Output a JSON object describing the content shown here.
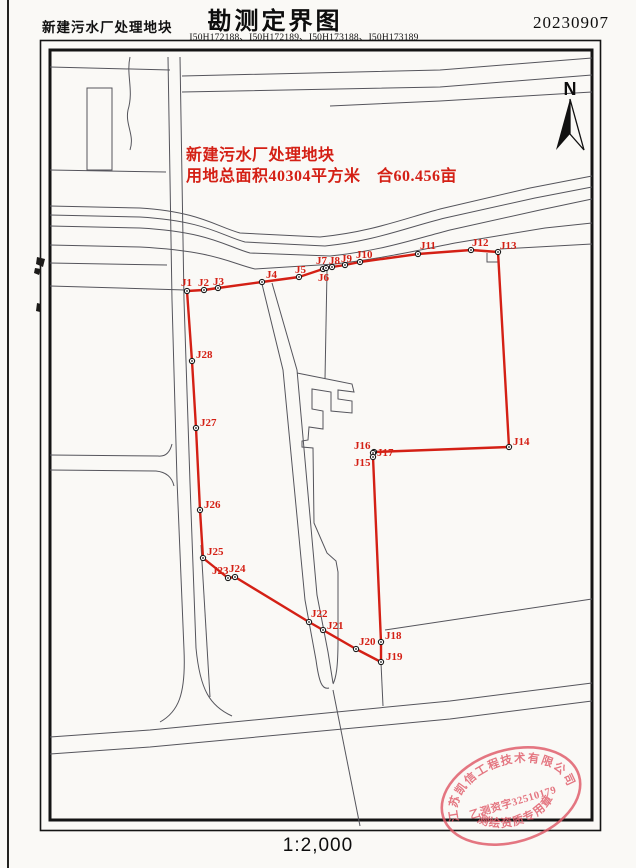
{
  "header": {
    "project_label": "新建污水厂处理地块",
    "title": "勘测定界图",
    "sheet_numbers": "I50H172188、I50H172189、I50H173188、I50H173189",
    "date": "20230907"
  },
  "map_annotation": {
    "line1": "新建污水厂处理地块",
    "line2": "用地总面积40304平方米　合60.456亩"
  },
  "land_area": {
    "sqm": 40304,
    "mu": 60.456
  },
  "north_arrow": {
    "label": "N"
  },
  "scale_bar": {
    "label": "1:2,000"
  },
  "seal": {
    "company": "江苏凯信工程技术有限公司",
    "license_no": "乙测资字32510179",
    "seal_type": "测绘资质专用章"
  },
  "colors": {
    "boundary_red": "#d42015",
    "seal_pink": "#e05a68",
    "map_line_gray": "#55555c"
  },
  "boundary_points": [
    {
      "name": "J1",
      "x": 187,
      "y": 291,
      "lx": 181,
      "ly": 286
    },
    {
      "name": "J2",
      "x": 204,
      "y": 290,
      "lx": 198,
      "ly": 286
    },
    {
      "name": "J3",
      "x": 218,
      "y": 288,
      "lx": 213,
      "ly": 285
    },
    {
      "name": "J4",
      "x": 262,
      "y": 282,
      "lx": 266,
      "ly": 278
    },
    {
      "name": "J5",
      "x": 299,
      "y": 277,
      "lx": 295,
      "ly": 273
    },
    {
      "name": "J6",
      "x": 323,
      "y": 269,
      "lx": 318,
      "ly": 281
    },
    {
      "name": "J7",
      "x": 326,
      "y": 268,
      "lx": 316,
      "ly": 264
    },
    {
      "name": "J8",
      "x": 332,
      "y": 267,
      "lx": 329,
      "ly": 264
    },
    {
      "name": "J9",
      "x": 345,
      "y": 265,
      "lx": 341,
      "ly": 262
    },
    {
      "name": "J10",
      "x": 360,
      "y": 262,
      "lx": 356,
      "ly": 258
    },
    {
      "name": "J11",
      "x": 418,
      "y": 254,
      "lx": 420,
      "ly": 249
    },
    {
      "name": "J12",
      "x": 471,
      "y": 250,
      "lx": 472,
      "ly": 246
    },
    {
      "name": "J13",
      "x": 498,
      "y": 252,
      "lx": 500,
      "ly": 249
    },
    {
      "name": "J14",
      "x": 509,
      "y": 447,
      "lx": 513,
      "ly": 445
    },
    {
      "name": "J17",
      "x": 374,
      "y": 452,
      "lx": 377,
      "ly": 456
    },
    {
      "name": "J16",
      "x": 373,
      "y": 453,
      "lx": 354,
      "ly": 449
    },
    {
      "name": "J15",
      "x": 373,
      "y": 457,
      "lx": 354,
      "ly": 466
    },
    {
      "name": "J18",
      "x": 381,
      "y": 642,
      "lx": 385,
      "ly": 639
    },
    {
      "name": "J19",
      "x": 381,
      "y": 662,
      "lx": 386,
      "ly": 660
    },
    {
      "name": "J20",
      "x": 356,
      "y": 649,
      "lx": 359,
      "ly": 645
    },
    {
      "name": "J21",
      "x": 323,
      "y": 630,
      "lx": 327,
      "ly": 629
    },
    {
      "name": "J22",
      "x": 309,
      "y": 622,
      "lx": 311,
      "ly": 617
    },
    {
      "name": "J24",
      "x": 235,
      "y": 577,
      "lx": 229,
      "ly": 572
    },
    {
      "name": "J23",
      "x": 228,
      "y": 578,
      "lx": 212,
      "ly": 574
    },
    {
      "name": "J25",
      "x": 203,
      "y": 558,
      "lx": 207,
      "ly": 555
    },
    {
      "name": "J26",
      "x": 200,
      "y": 510,
      "lx": 204,
      "ly": 508
    },
    {
      "name": "J27",
      "x": 196,
      "y": 428,
      "lx": 200,
      "ly": 426
    },
    {
      "name": "J28",
      "x": 192,
      "y": 361,
      "lx": 196,
      "ly": 358
    }
  ]
}
